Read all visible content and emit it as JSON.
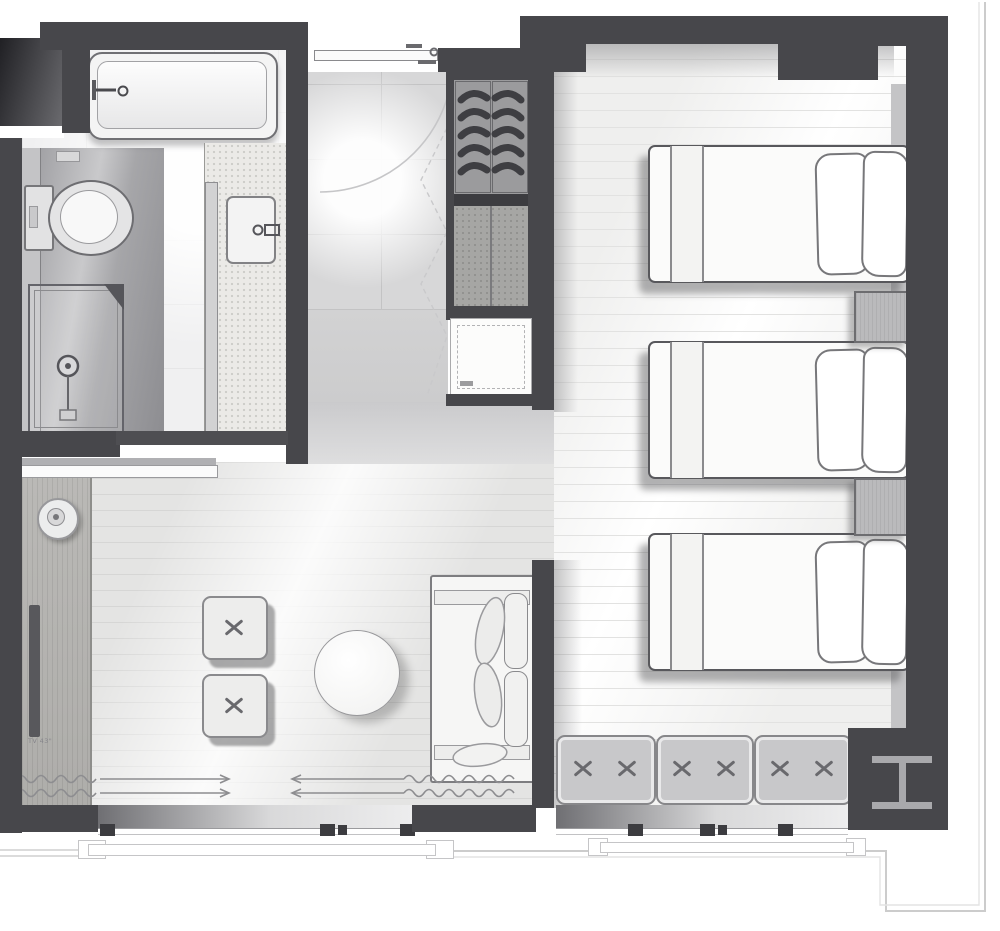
{
  "plan": {
    "title": "hotel-guestroom-floor-plan",
    "tv_label": "TV 43\"",
    "rooms": [
      {
        "name": "bathroom",
        "fixtures": [
          "bathtub",
          "toilet",
          "shower-enclosure",
          "vanity-counter",
          "sink",
          "sliding-door",
          "mirror"
        ]
      },
      {
        "name": "entry-hall",
        "fixtures": [
          "entry-door",
          "door-swing-arc",
          "wardrobe-hanging-rail",
          "wardrobe-lower-cabinet",
          "luggage-rack"
        ]
      },
      {
        "name": "living-area",
        "furniture": [
          "tv-console",
          "wall-mounted-tv",
          "round-side-object",
          "ottoman-1",
          "ottoman-2",
          "round-table",
          "two-seat-sofa",
          "curtain-track-annotation",
          "window"
        ]
      },
      {
        "name": "bedroom",
        "furniture": [
          "single-bed-1",
          "single-bed-2",
          "single-bed-3",
          "nightstand-1",
          "nightstand-2",
          "headboard-panel",
          "window-bench",
          "sliding-window",
          "steel-column"
        ]
      }
    ],
    "counts": {
      "single_beds": 3,
      "ottomans": 2,
      "nightstands": 2,
      "bench_cushions": 3,
      "bench_x_marks": 6,
      "hanger_ribs": 10
    },
    "colors": {
      "wall": "#47474b",
      "floor_living": "#e4e4e3",
      "floor_bedroom": "#f5f5f4",
      "floor_entry": "#d7d7d8",
      "wet_zone": "#96969a",
      "fixture_outline": "#77777a",
      "cushion_fill": "#c8c8ca",
      "shadow": "rgba(84,84,87,0.45)",
      "exterior_line": "#cfcfcf"
    },
    "annotations": {
      "curtain_direction_arrows": 2,
      "door_swing_arcs": 1
    }
  }
}
